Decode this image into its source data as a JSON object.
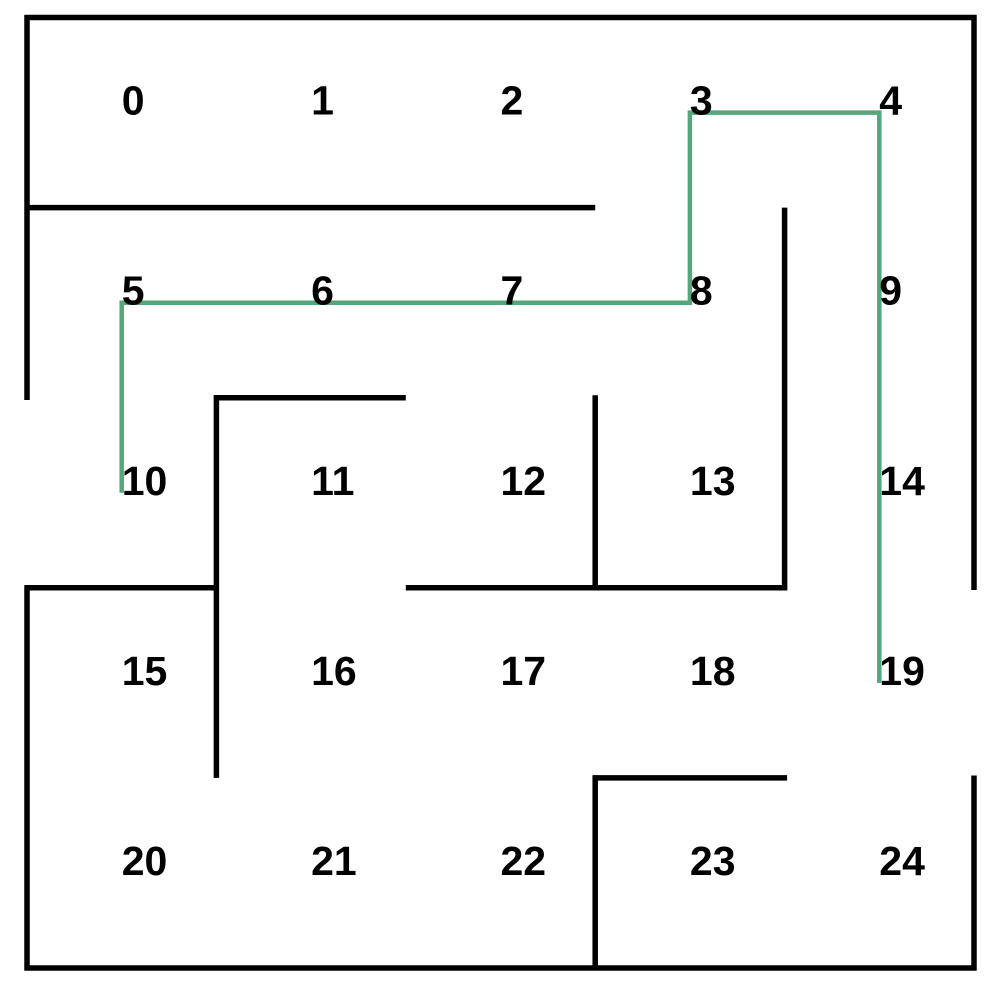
{
  "title": "maze-grid-with-solution-path",
  "canvas": {
    "width": 1002,
    "height": 990,
    "background": "#ffffff"
  },
  "maze": {
    "rows": 5,
    "cols": 5,
    "bounds": {
      "left": 27,
      "top": 17.5,
      "right": 974,
      "bottom": 968
    },
    "wall_style": {
      "color": "#000000",
      "thickness": 5.5
    },
    "label_style": {
      "color": "#000000",
      "font_size": 41,
      "font_weight": "bold"
    },
    "openings": [
      {
        "cell": 10,
        "side": "left",
        "role": "entrance"
      },
      {
        "cell": 19,
        "side": "right",
        "role": "exit"
      }
    ],
    "cells": [
      {
        "label": "0",
        "x": 121.7,
        "y": 114.6
      },
      {
        "label": "1",
        "x": 311.1,
        "y": 114.6
      },
      {
        "label": "2",
        "x": 500.5,
        "y": 114.6
      },
      {
        "label": "3",
        "x": 689.9,
        "y": 114.6
      },
      {
        "label": "4",
        "x": 879.3,
        "y": 114.6
      },
      {
        "label": "5",
        "x": 121.7,
        "y": 304.7
      },
      {
        "label": "6",
        "x": 311.1,
        "y": 304.7
      },
      {
        "label": "7",
        "x": 500.5,
        "y": 304.7
      },
      {
        "label": "8",
        "x": 689.9,
        "y": 304.7
      },
      {
        "label": "9",
        "x": 879.3,
        "y": 304.7
      },
      {
        "label": "10",
        "x": 121.7,
        "y": 494.8
      },
      {
        "label": "11",
        "x": 311.1,
        "y": 494.8
      },
      {
        "label": "12",
        "x": 500.5,
        "y": 494.8
      },
      {
        "label": "13",
        "x": 689.9,
        "y": 494.8
      },
      {
        "label": "14",
        "x": 879.3,
        "y": 494.8
      },
      {
        "label": "15",
        "x": 121.7,
        "y": 684.9
      },
      {
        "label": "16",
        "x": 311.1,
        "y": 684.9
      },
      {
        "label": "17",
        "x": 500.5,
        "y": 684.9
      },
      {
        "label": "18",
        "x": 689.9,
        "y": 684.9
      },
      {
        "label": "19",
        "x": 879.3,
        "y": 684.9
      },
      {
        "label": "20",
        "x": 121.7,
        "y": 875.0
      },
      {
        "label": "21",
        "x": 311.1,
        "y": 875.0
      },
      {
        "label": "22",
        "x": 500.5,
        "y": 875.0
      },
      {
        "label": "23",
        "x": 689.9,
        "y": 875.0
      },
      {
        "label": "24",
        "x": 879.3,
        "y": 875.0
      }
    ],
    "walls": [
      {
        "name": "outer-top",
        "x1": 24.5,
        "y1": 17.5,
        "x2": 976.5,
        "y2": 17.5
      },
      {
        "name": "outer-bottom",
        "x1": 24.5,
        "y1": 968,
        "x2": 976.5,
        "y2": 968
      },
      {
        "name": "outer-left-upper",
        "x1": 27,
        "y1": 15,
        "x2": 27,
        "y2": 400
      },
      {
        "name": "outer-left-lower",
        "x1": 27,
        "y1": 585.5,
        "x2": 27,
        "y2": 970.5
      },
      {
        "name": "outer-right-upper",
        "x1": 974,
        "y1": 15,
        "x2": 974,
        "y2": 590
      },
      {
        "name": "outer-right-lower",
        "x1": 974,
        "y1": 775.5,
        "x2": 974,
        "y2": 970.5
      },
      {
        "name": "below-cells-0-1-2",
        "x1": 24.5,
        "y1": 207.6,
        "x2": 595.2,
        "y2": 207.6
      },
      {
        "name": "below-cell-6",
        "x1": 213.9,
        "y1": 397.7,
        "x2": 405.8,
        "y2": 397.7
      },
      {
        "name": "below-cell-10",
        "x1": 24.5,
        "y1": 587.8,
        "x2": 216.4,
        "y2": 587.8
      },
      {
        "name": "below-cells-12-13",
        "x1": 405.8,
        "y1": 587.8,
        "x2": 787.1,
        "y2": 587.8
      },
      {
        "name": "below-cell-18",
        "x1": 592.7,
        "y1": 777.9,
        "x2": 787.1,
        "y2": 777.9
      },
      {
        "name": "right-of-cells-10-15",
        "x1": 216.4,
        "y1": 395.2,
        "x2": 216.4,
        "y2": 777.9
      },
      {
        "name": "right-of-cell-12",
        "x1": 595.2,
        "y1": 395.2,
        "x2": 595.2,
        "y2": 590.3
      },
      {
        "name": "right-of-cell-22",
        "x1": 595.2,
        "y1": 775.4,
        "x2": 595.2,
        "y2": 970.5
      },
      {
        "name": "right-of-cells-8-13",
        "x1": 784.6,
        "y1": 207.6,
        "x2": 784.6,
        "y2": 590.3
      }
    ],
    "solution_path": {
      "cells": [
        10,
        5,
        6,
        7,
        8,
        3,
        4,
        9,
        14,
        19
      ],
      "color": "#56a57c",
      "stroke_width": 4.5,
      "points": [
        [
          121.7,
          492.7
        ],
        [
          121.7,
          302.7
        ],
        [
          689.9,
          302.7
        ],
        [
          689.9,
          112.6
        ],
        [
          879.3,
          112.6
        ],
        [
          879.3,
          682.9
        ]
      ]
    }
  }
}
